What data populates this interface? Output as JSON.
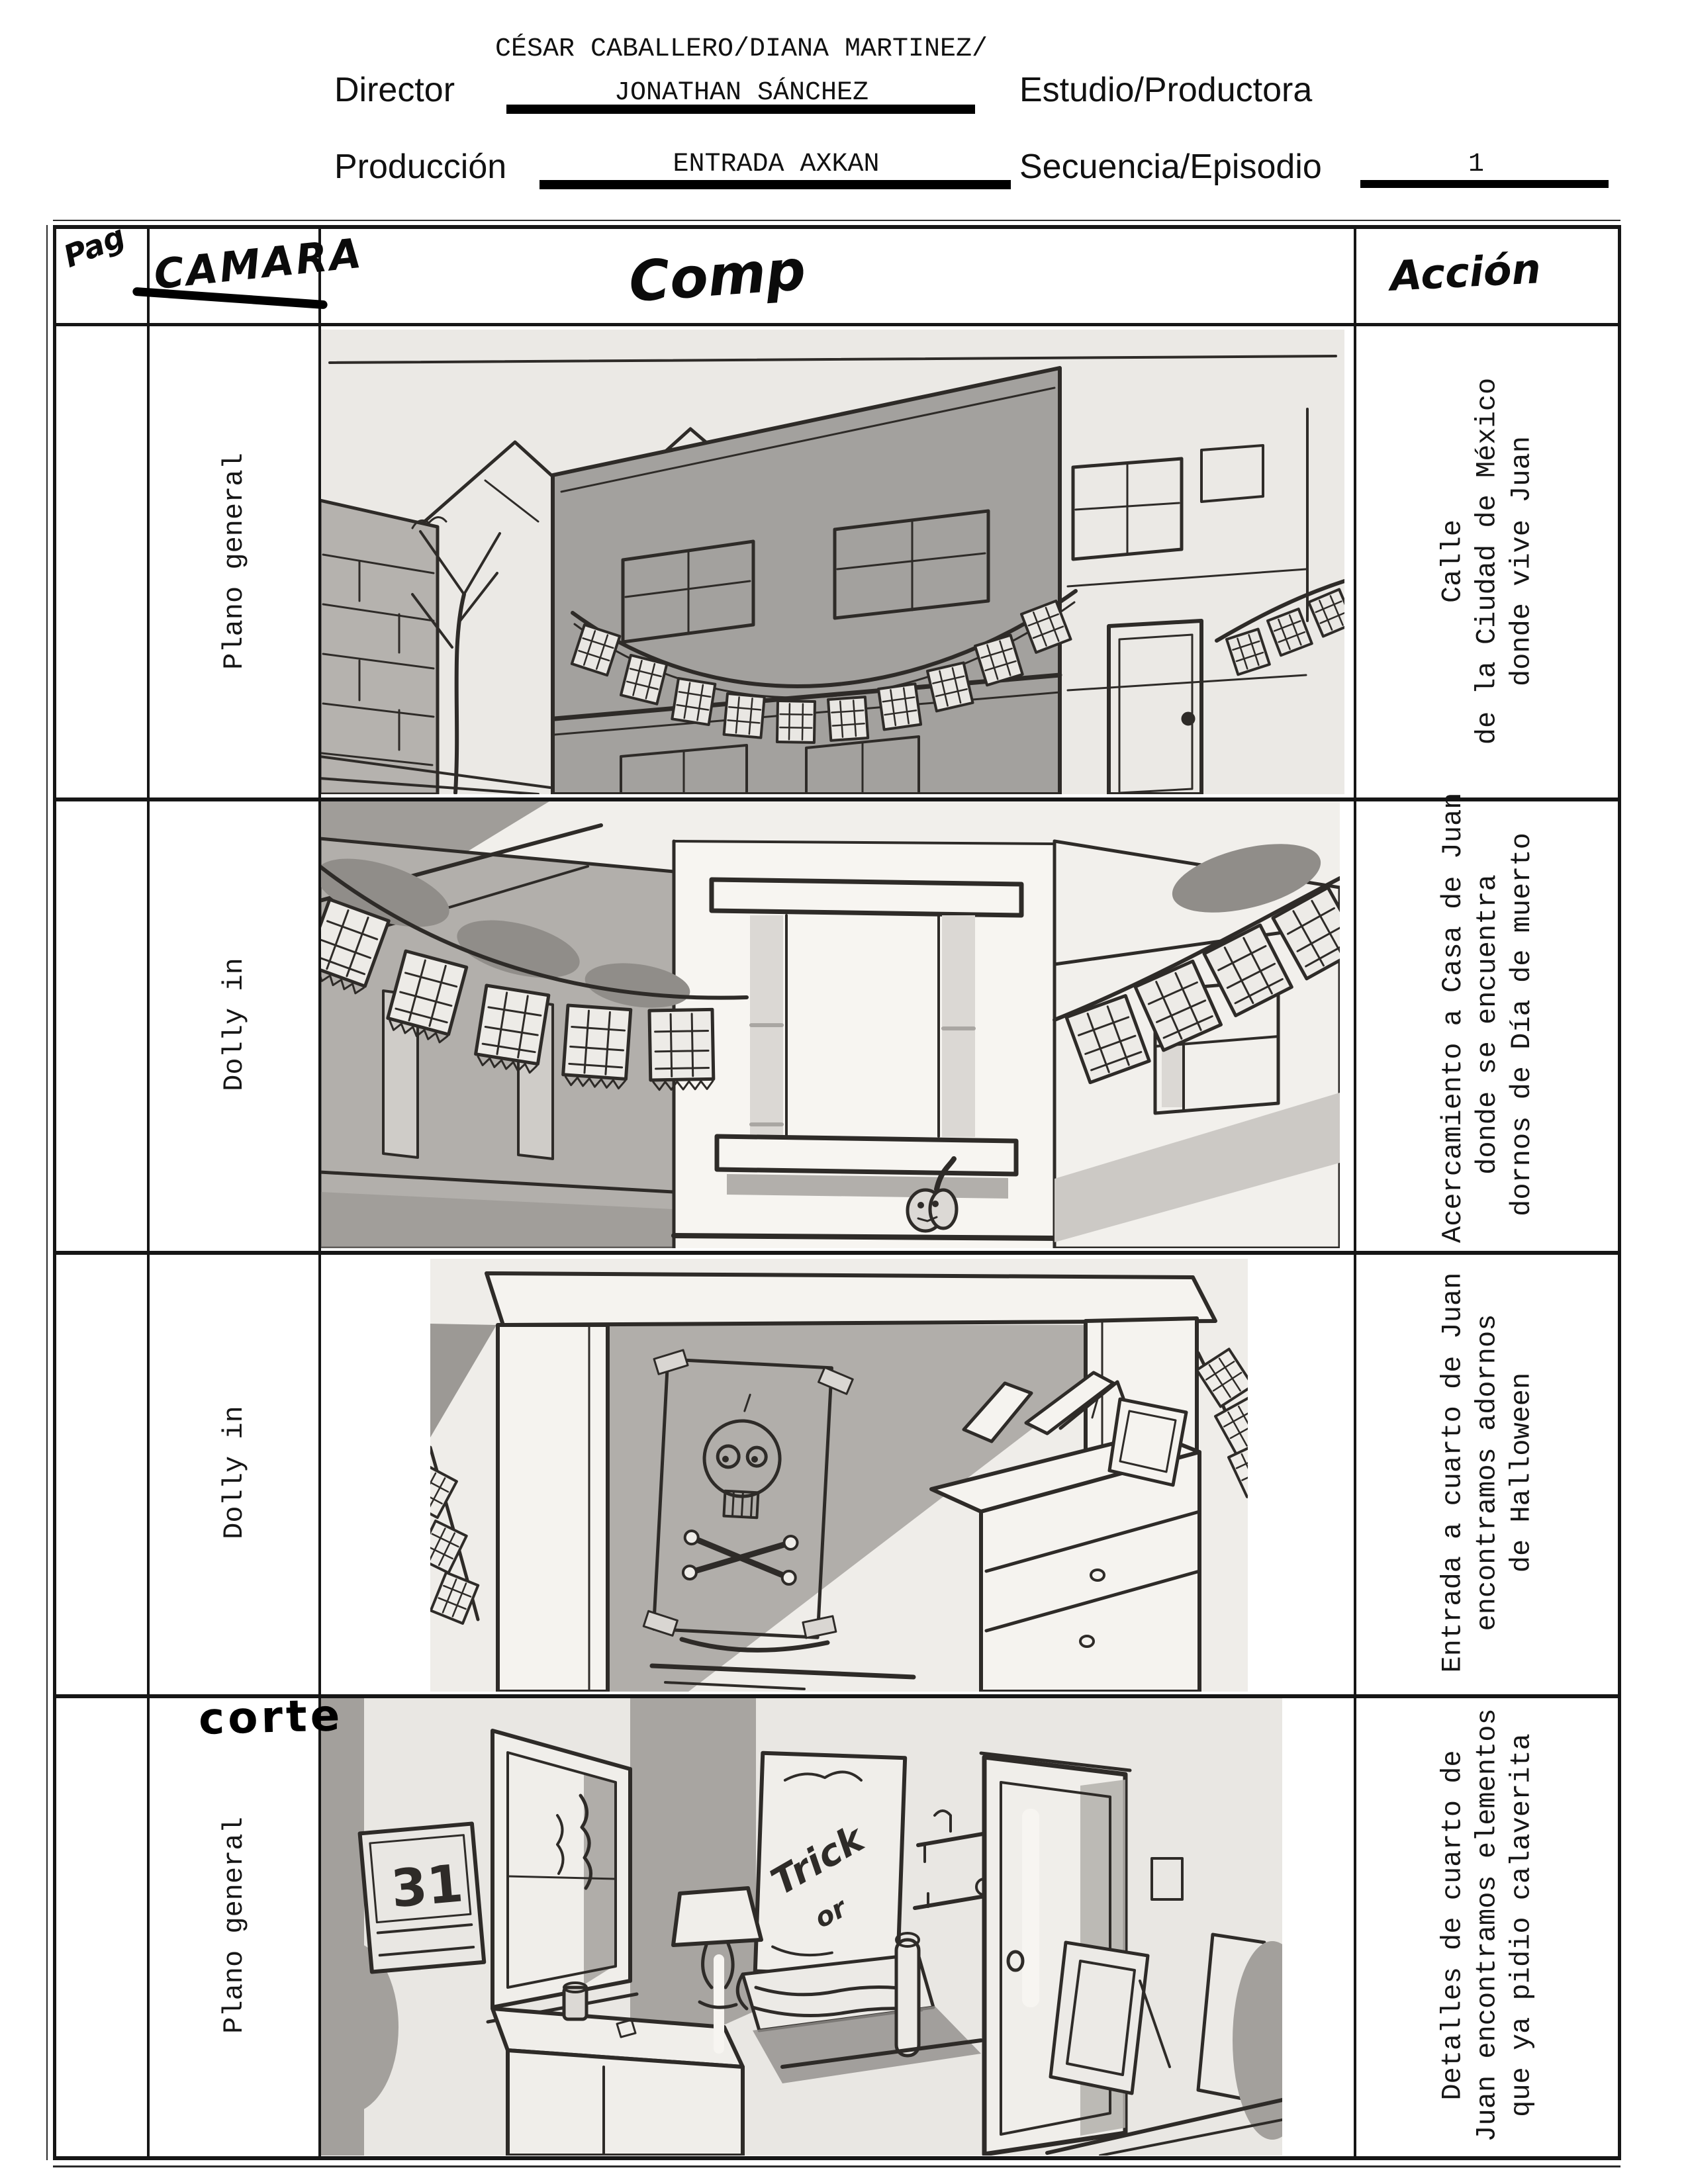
{
  "header": {
    "director_label": "Director",
    "director_value_line1": "CÉSAR CABALLERO/DIANA MARTINEZ/",
    "director_value_line2": "JONATHAN SÁNCHEZ",
    "estudio_label": "Estudio/Productora",
    "produccion_label": "Producción",
    "produccion_value": "ENTRADA AXKAN",
    "secuencia_label": "Secuencia/Episodio",
    "secuencia_value": "1"
  },
  "table": {
    "headers": {
      "page_col": "Pag",
      "camera_col": "CAMARA",
      "comp_col": "Comp",
      "action_col": "Acción"
    },
    "rows": [
      {
        "camera": "Plano general",
        "action_lines": [
          "Calle",
          "de la Ciudad de México",
          "donde vive Juan"
        ],
        "sketch": "street-exterior-with-papel-picado"
      },
      {
        "camera": "Dolly in",
        "action_lines": [
          "Acercamiento a Casa de Juan",
          "donde se encuentra",
          "dornos de Día de muerto"
        ],
        "sketch": "house-corner-window-pumpkin"
      },
      {
        "camera": "Dolly in",
        "action_lines": [
          "Entrada a cuarto de Juan",
          "encontramos adornos",
          "de Halloween"
        ],
        "sketch": "room-entrance-skull-poster"
      },
      {
        "camera": "Plano general",
        "annotation": "corte",
        "action_lines": [
          "Detalles de cuarto de",
          "Juan encontramos elementos",
          "que ya pidio calaverita"
        ],
        "sketch": "room-interior-details",
        "sketch_texts": {
          "calendar": "31",
          "poster_line1": "Trick",
          "poster_line2": "or"
        }
      }
    ]
  }
}
